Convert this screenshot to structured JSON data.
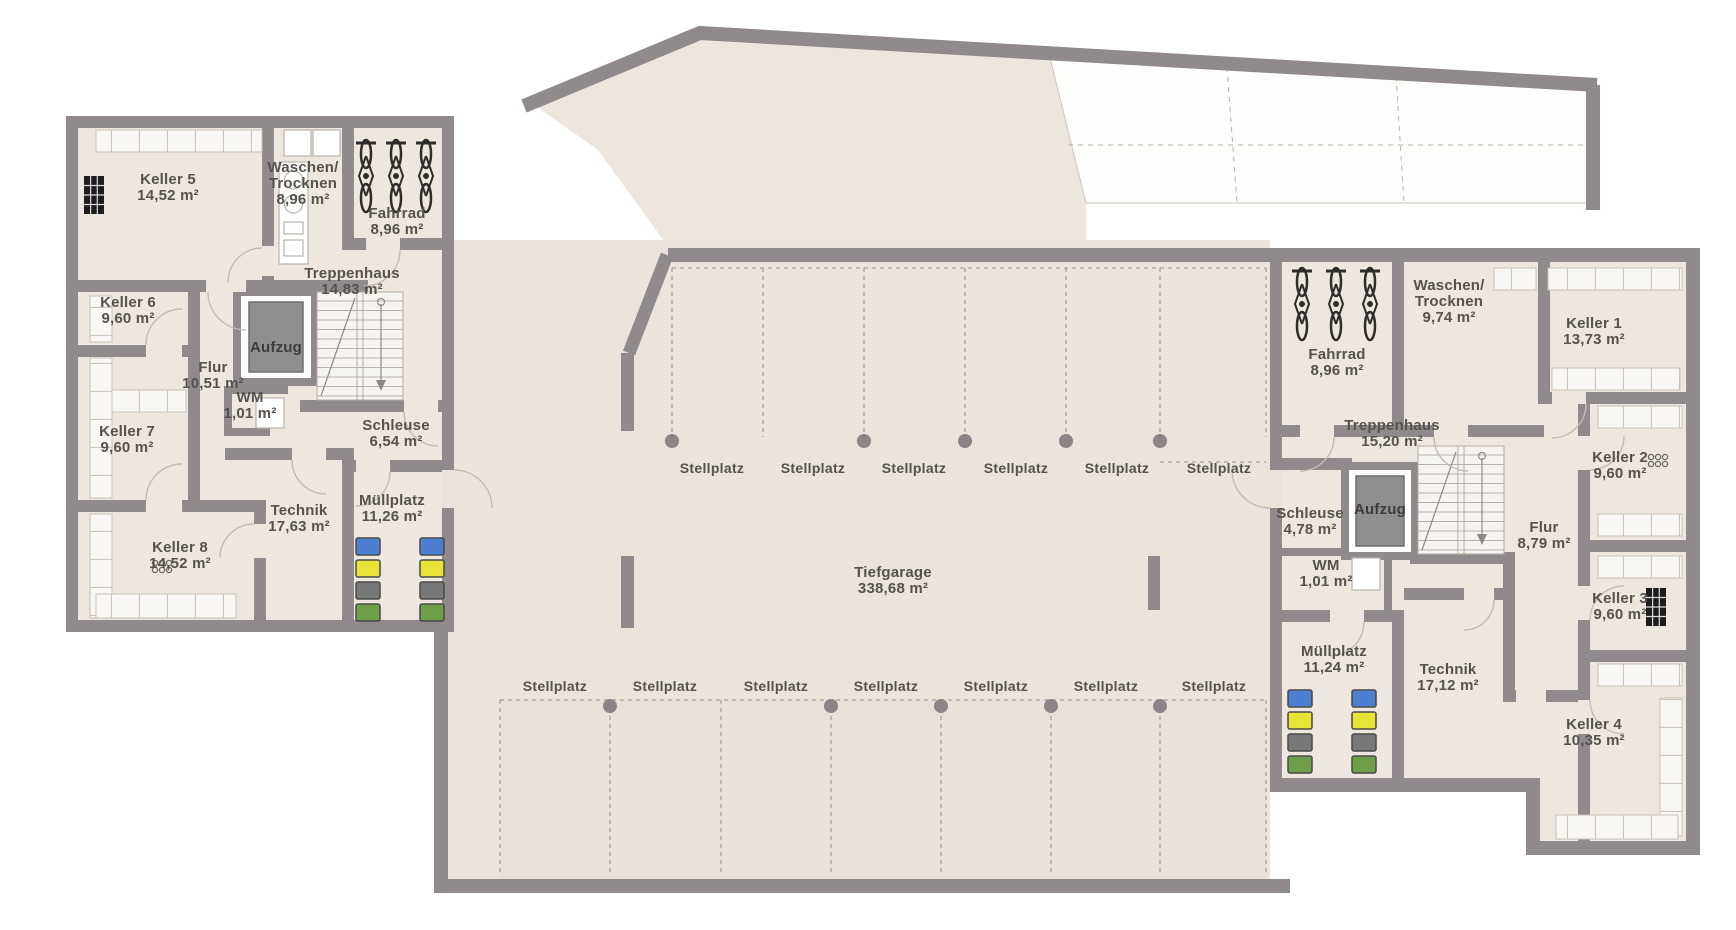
{
  "plan": {
    "colors": {
      "wall": "#918a8c",
      "room_floor": "#ede7df",
      "garage_floor": "#eae4dd",
      "ramp_floor": "#ece6de",
      "stall_tint": "#e7e1d9",
      "dashed_line": "#a9a19a",
      "pillar": "#8d8487",
      "label_text": "#56524e",
      "bin_blue": "#4d7fd0",
      "bin_yellow": "#e8e437",
      "bin_gray": "#787878",
      "bin_green": "#6f9e48",
      "elevator_cab": "#8f8f8f"
    },
    "garage": {
      "name": "Tiefgarage",
      "area": "338,68 m²",
      "stall_label": "Stellplatz",
      "top_row_stalls": 6,
      "bottom_row_stalls": 7
    },
    "left_wing": {
      "rooms": [
        {
          "name": "Keller 5",
          "area": "14,52 m²"
        },
        {
          "name": "Waschen/",
          "name2": "Trocknen",
          "area": "8,96 m²"
        },
        {
          "name": "Fahrrad",
          "area": "8,96 m²"
        },
        {
          "name": "Treppenhaus",
          "area": "14,83 m²"
        },
        {
          "name": "Keller 6",
          "area": "9,60 m²"
        },
        {
          "name": "Aufzug"
        },
        {
          "name": "Flur",
          "area": "10,51 m²"
        },
        {
          "name": "WM",
          "area": "1,01 m²"
        },
        {
          "name": "Keller 7",
          "area": "9,60 m²"
        },
        {
          "name": "Schleuse",
          "area": "6,54 m²"
        },
        {
          "name": "Technik",
          "area": "17,63 m²"
        },
        {
          "name": "Müllplatz",
          "area": "11,26 m²"
        },
        {
          "name": "Keller 8",
          "area": "14,52 m²"
        }
      ]
    },
    "right_wing": {
      "rooms": [
        {
          "name": "Fahrrad",
          "area": "8,96 m²"
        },
        {
          "name": "Waschen/",
          "name2": "Trocknen",
          "area": "9,74 m²"
        },
        {
          "name": "Keller 1",
          "area": "13,73 m²"
        },
        {
          "name": "Treppenhaus",
          "area": "15,20 m²"
        },
        {
          "name": "Keller 2",
          "area": "9,60 m²"
        },
        {
          "name": "Schleuse",
          "area": "4,78 m²"
        },
        {
          "name": "Aufzug"
        },
        {
          "name": "Flur",
          "area": "8,79 m²"
        },
        {
          "name": "WM",
          "area": "1,01 m²"
        },
        {
          "name": "Keller 3",
          "area": "9,60 m²"
        },
        {
          "name": "Müllplatz",
          "area": "11,24 m²"
        },
        {
          "name": "Technik",
          "area": "17,12 m²"
        },
        {
          "name": "Keller 4",
          "area": "10,35 m²"
        }
      ]
    }
  }
}
